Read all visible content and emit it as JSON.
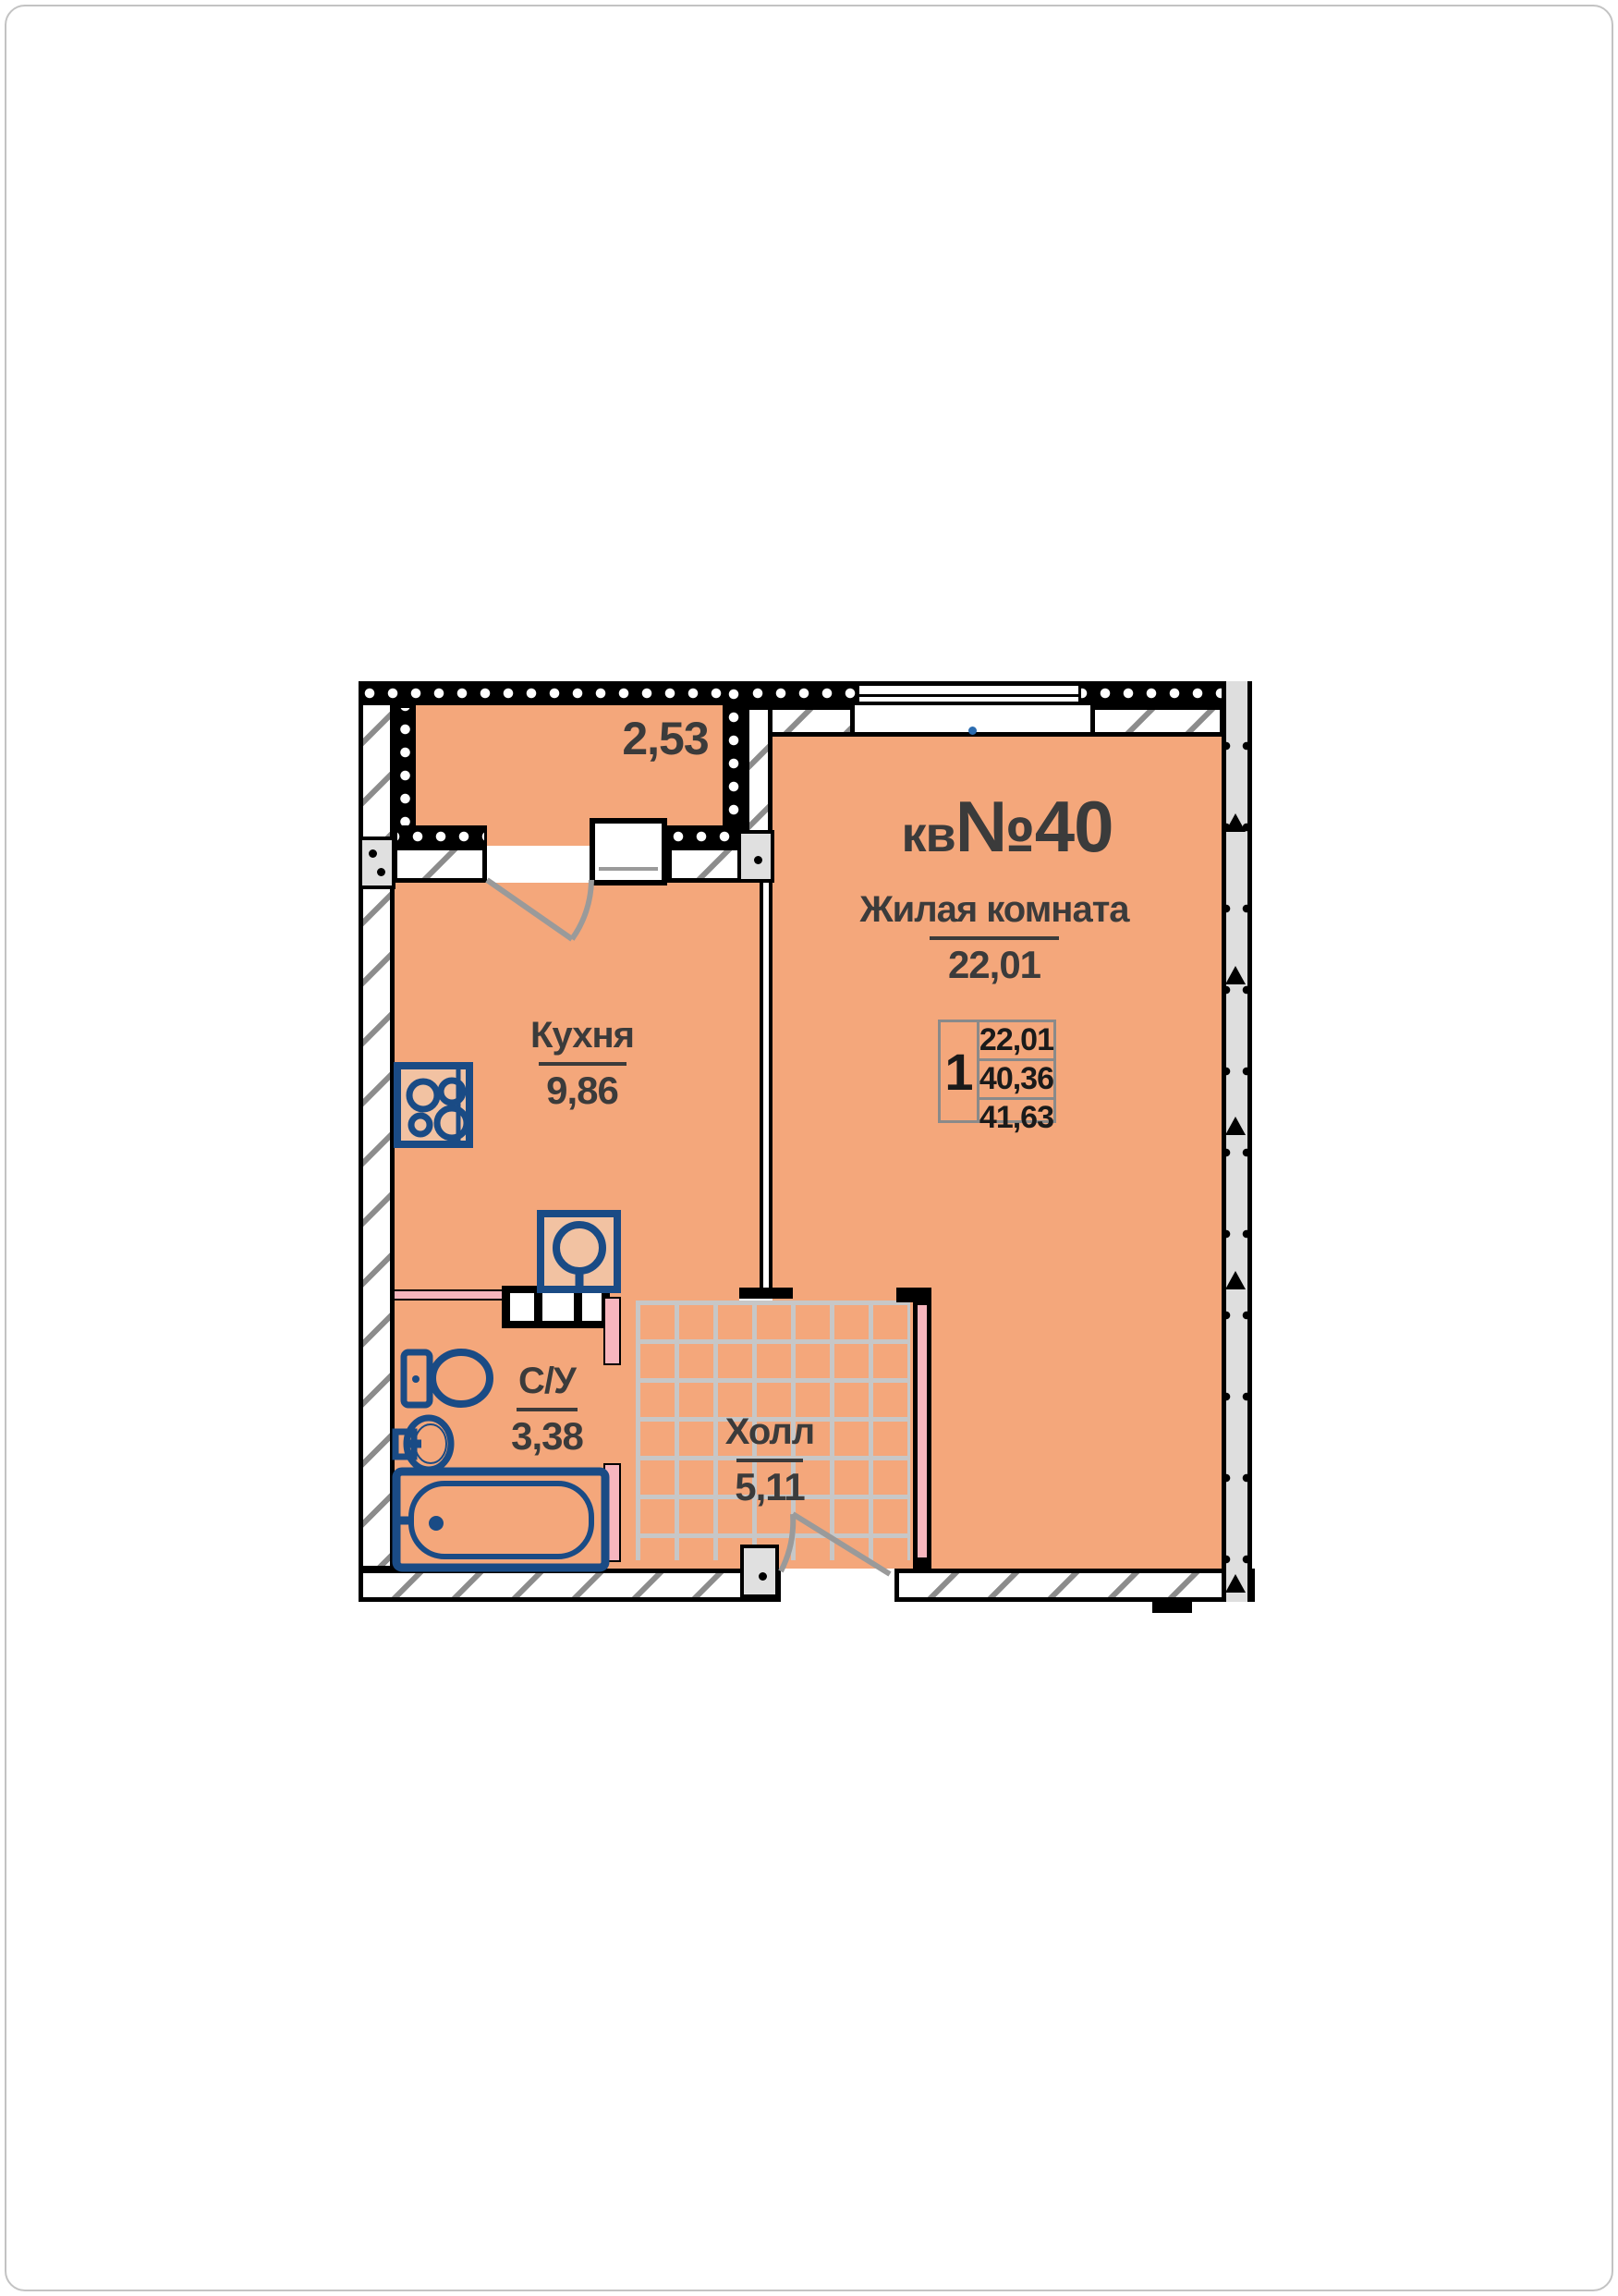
{
  "title": {
    "prefix": "кв",
    "number": "№40"
  },
  "rooms": {
    "living": {
      "name": "Жилая комната",
      "area": "22,01"
    },
    "kitchen": {
      "name": "Кухня",
      "area": "9,86"
    },
    "bathroom": {
      "name": "С/У",
      "area": "3,38"
    },
    "hall": {
      "name": "Холл",
      "area": "5,11"
    },
    "balcony": {
      "area": "2,53"
    }
  },
  "info_table": {
    "rooms_count": "1",
    "values": [
      "22,01",
      "40,36",
      "41,63"
    ]
  },
  "colors": {
    "floor": "#f4a77b",
    "walls": "#000000",
    "hatch": "#8c8c8c",
    "panel": "#dedede",
    "tile_lines": "#c7c7c7",
    "partition_pink": "#f7b6be",
    "fixtures_blue": "#1a4b85",
    "door_swing": "#9a9a9a",
    "text": "#3b3b3b",
    "table_border": "#8a8a8a",
    "window_dot_blue": "#2b6cb0"
  },
  "icons": [
    "stove-icon",
    "kitchen-sink-icon",
    "toilet-icon",
    "washbasin-icon",
    "bathtub-icon",
    "balcony-door-swing-icon",
    "entrance-door-swing-icon"
  ]
}
